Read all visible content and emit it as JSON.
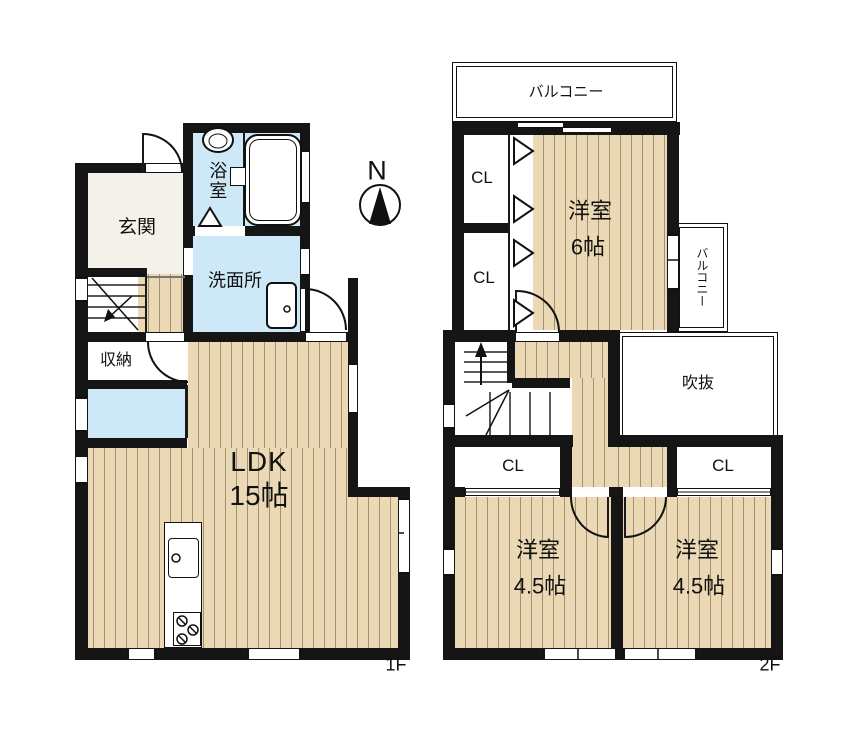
{
  "colors": {
    "wall": "#151515",
    "floor_tan": "#EBD9B5",
    "floor_stripe": "#A2906E",
    "water_blue": "#CDE8F6",
    "entry_beige": "#F4F1EA",
    "line": "#111111"
  },
  "compass": {
    "north_label": "N"
  },
  "floor1": {
    "label": "1F",
    "entrance": "玄関",
    "bathroom": "浴室",
    "washroom": "洗面所",
    "storage": "収納",
    "ldk_name": "LDK",
    "ldk_size": "15帖"
  },
  "floor2": {
    "label": "2F",
    "balcony_top": "バルコニー",
    "balcony_side": "バルコニー",
    "closet_nw_upper": "CL",
    "closet_nw_lower": "CL",
    "room6_name": "洋室",
    "room6_size": "6帖",
    "void": "吹抜",
    "closet_sw": "CL",
    "closet_se": "CL",
    "room45_left_name": "洋室",
    "room45_left_size": "4.5帖",
    "room45_right_name": "洋室",
    "room45_right_size": "4.5帖"
  }
}
